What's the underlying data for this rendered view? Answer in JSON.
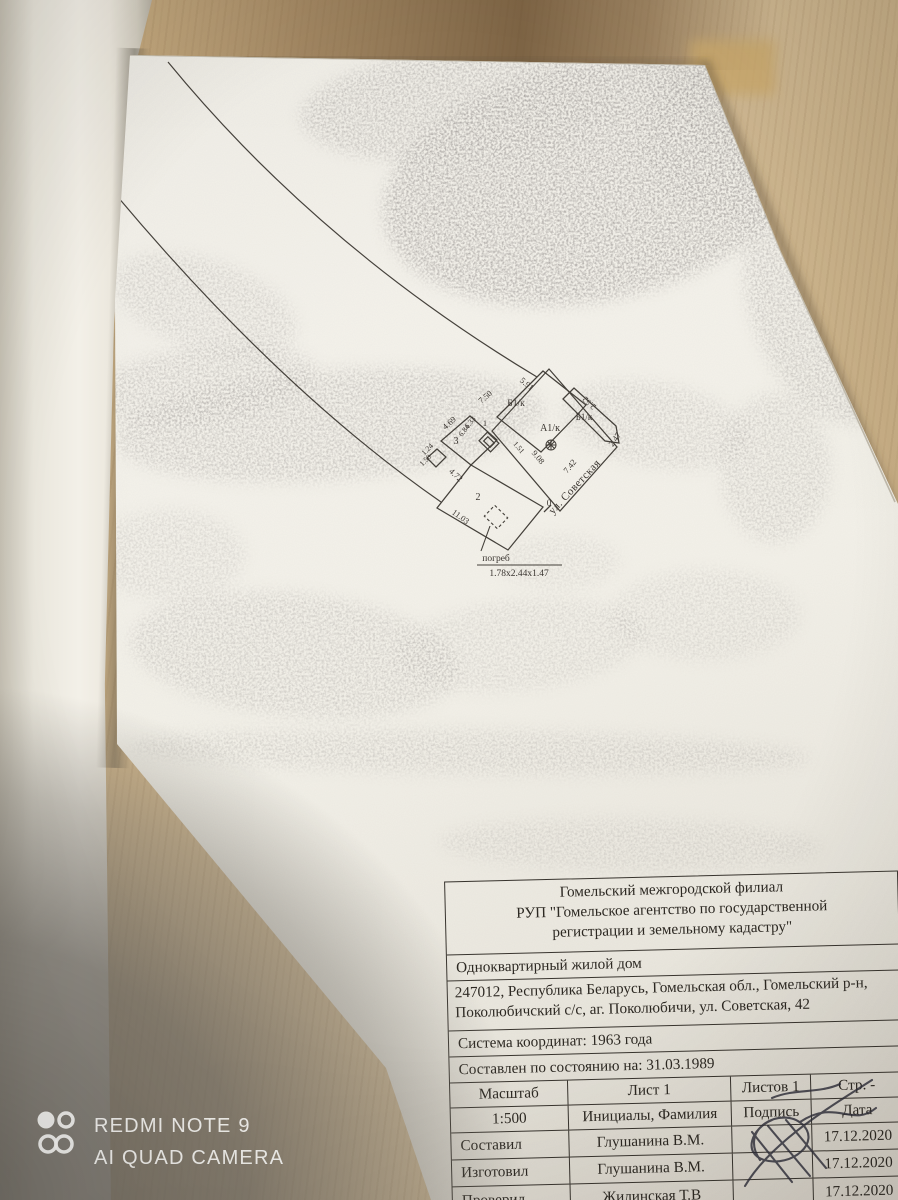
{
  "plan": {
    "rooms": [
      "Б1/к",
      "Б1/к",
      "А1/к",
      "3",
      "2",
      "1"
    ],
    "dims": [
      "7.50",
      "5.91",
      "2.52",
      "2.47",
      "9.08",
      "7.42",
      "1.51",
      "4.69",
      "6.33",
      "6.84",
      "1.24",
      "1.50",
      "4.72",
      "11.03"
    ],
    "zero_mark": "0",
    "street": "ул. Советская",
    "cellar": {
      "label": "погреб",
      "size": "1.78х2.44х1.47"
    }
  },
  "title_block": {
    "org_lines": [
      "Гомельский межгородской филиал",
      "РУП \"Гомельское агентство по государственной",
      "регистрации и земельному кадастру\""
    ],
    "object_type": "Одноквартирный жилой дом",
    "address_lines": [
      "247012, Республика Беларусь, Гомельская обл., Гомельский р-н,",
      "Поколюбичский с/с, аг. Поколюбичи, ул. Советская, 42"
    ],
    "coord_system": "Система координат: 1963 года",
    "as_of": "Составлен по состоянию на: 31.03.1989",
    "scale_label": "Масштаб",
    "sheet": "Лист 1",
    "sheets": "Листов 1",
    "page": "Стр. -",
    "scale_value": "1:500",
    "name_header": "Инициалы, Фамилия",
    "sign_header": "Подпись",
    "date_header": "Дата",
    "rows": [
      {
        "role": "Составил",
        "name": "Глушанина В.М.",
        "date": "17.12.2020"
      },
      {
        "role": "Изготовил",
        "name": "Глушанина В.М.",
        "date": "17.12.2020"
      },
      {
        "role": "Проверил",
        "name": "Жилинская Т.В",
        "date": "17.12.2020"
      }
    ]
  },
  "watermark": {
    "line1": "REDMI NOTE 9",
    "line2": "AI QUAD CAMERA"
  },
  "colors": {
    "wood": "#cab189",
    "page": "#f3f1ea",
    "shadow": "#a7a39c",
    "ink": "#3a3530"
  }
}
